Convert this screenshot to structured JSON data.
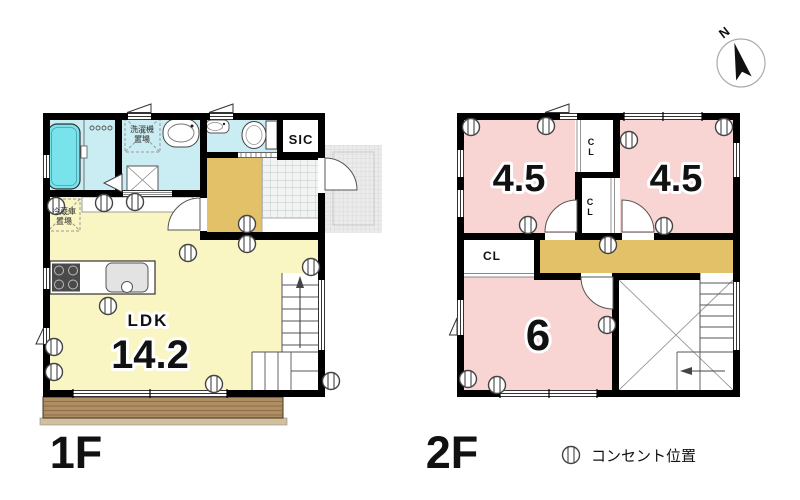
{
  "compass": {
    "north_label": "N"
  },
  "legend": {
    "outlet_icon": "outlet-circle",
    "outlet_label": "コンセント位置"
  },
  "floor1": {
    "label": "1F",
    "ldk": {
      "name": "LDK",
      "area": "14.2"
    },
    "sic_label": "SIC",
    "washer_place_lines": [
      "洗濯機",
      "置場"
    ],
    "fridge_place_lines": [
      "冷蔵庫",
      "置場"
    ]
  },
  "floor2": {
    "label": "2F",
    "room_left": {
      "area": "4.5"
    },
    "room_right": {
      "area": "4.5"
    },
    "room_bottom": {
      "area": "6"
    },
    "closet_label": "CL",
    "closet_label_vertical_lines": [
      "C",
      "L"
    ]
  },
  "colors": {
    "wall": "#000000",
    "ldk_floor": "#f9f6c3",
    "bedroom_floor": "#f8d4d2",
    "wet_area_floor": "#c9edf2",
    "bathtub": "#79e3ec",
    "hallway_floor": "#e3c169",
    "wood_deck": "#b08e63",
    "porch_tile": "#ebebeb"
  }
}
